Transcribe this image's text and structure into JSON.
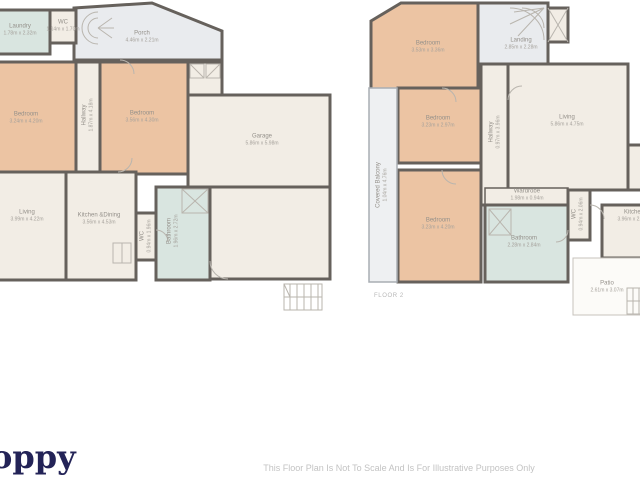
{
  "branding": {
    "logo_text": "oppy",
    "logo_color": "#232357"
  },
  "disclaimer": {
    "text": "This Floor Plan Is Not To Scale And Is For Illustrative Purposes Only"
  },
  "palette": {
    "wall": "#66615c",
    "room_cream": "#f2ede5",
    "room_orange": "#ecc4a3",
    "room_teal": "#d9e5e0",
    "room_gray": "#e9ebee",
    "outdoor": "#fcfbf8",
    "thin_line": "#b9b5ae",
    "label_gray": "#94908a"
  },
  "plan1": {
    "rooms": {
      "laundry": {
        "name": "Laundry",
        "dims": "1.78m x 2.32m"
      },
      "wc_top": {
        "name": "WC",
        "dims": "1.14m x 1.70m"
      },
      "porch": {
        "name": "Porch",
        "dims": "4.46m x 2.21m"
      },
      "bedroom1": {
        "name": "Bedroom",
        "dims": "3.24m x 4.20m"
      },
      "hallway": {
        "name": "Hallway",
        "dims": "1.87m x 4.18m"
      },
      "bedroom2": {
        "name": "Bedroom",
        "dims": "3.56m x 4.30m"
      },
      "garage": {
        "name": "Garage",
        "dims": "5.86m x 5.98m"
      },
      "living": {
        "name": "Living",
        "dims": "3.99m x 4.22m"
      },
      "kitchen": {
        "name": "Kitchen &Dining",
        "dims": "3.56m x 4.53m"
      },
      "wc_small": {
        "name": "WC",
        "dims": "0.94m x 1.96m"
      },
      "bathroom": {
        "name": "Bathroom",
        "dims": "1.96m x 2.72m"
      }
    }
  },
  "plan2": {
    "floor_label": "FLOOR 2",
    "rooms": {
      "bedroom_a": {
        "name": "Bedroom",
        "dims": "3.53m x 3.36m"
      },
      "landing": {
        "name": "Landing",
        "dims": "2.85m x 2.28m"
      },
      "bedroom_b": {
        "name": "Bedroom",
        "dims": "3.23m x 2.97m"
      },
      "hallway": {
        "name": "Hallway",
        "dims": "0.97m x 3.96m"
      },
      "living": {
        "name": "Living",
        "dims": "5.86m x 4.75m"
      },
      "covered_balcony": {
        "name": "Covered Balcony",
        "dims": "1.04m x 4.76m"
      },
      "bedroom_c": {
        "name": "Bedroom",
        "dims": "3.23m x 4.20m"
      },
      "wardrobe": {
        "name": "Wardrobe",
        "dims": "1.98m x 0.94m"
      },
      "bathroom": {
        "name": "Bathroom",
        "dims": "2.28m x 2.84m"
      },
      "wc": {
        "name": "WC",
        "dims": "0.94m x 2.06m"
      },
      "kitchen": {
        "name": "Kitchen",
        "dims": "3.96m x 2.61m"
      },
      "patio": {
        "name": "Patio",
        "dims": "2.61m x 3.07m"
      }
    }
  }
}
